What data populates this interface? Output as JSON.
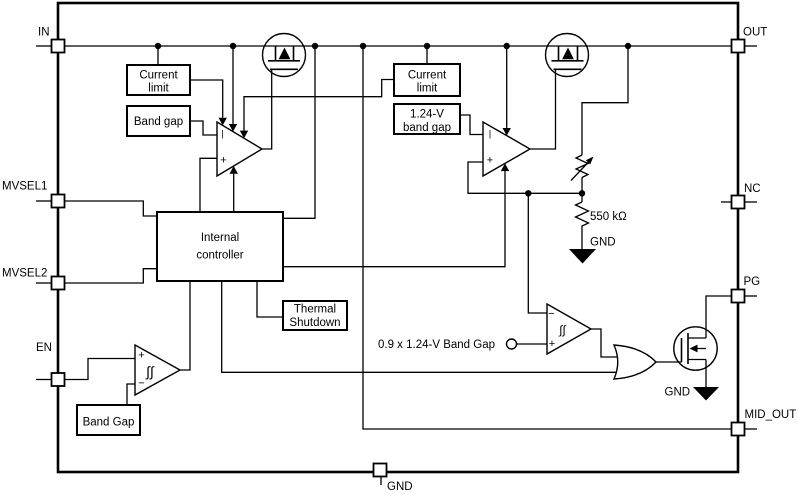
{
  "pins": {
    "in": "IN",
    "mvsel1": "MVSEL1",
    "mvsel2": "MVSEL2",
    "en": "EN",
    "out": "OUT",
    "nc": "NC",
    "pg": "PG",
    "mid_out": "MID_OUT",
    "gnd": "GND"
  },
  "blocks": {
    "current_limit_1": {
      "line1": "Current",
      "line2": "limit"
    },
    "band_gap_1": {
      "line1": "Band gap"
    },
    "current_limit_2": {
      "line1": "Current",
      "line2": "limit"
    },
    "band_gap_124": {
      "line1": "1.24-V",
      "line2": "band gap"
    },
    "internal_controller": {
      "line1": "Internal",
      "line2": "controller"
    },
    "thermal_shutdown": {
      "line1": "Thermal",
      "line2": "Shutdown"
    },
    "band_gap_en": {
      "line1": "Band Gap"
    }
  },
  "labels": {
    "resistor_550k": "550 kΩ",
    "bandgap_ref_09": "0.9 x 1.24-V Band Gap",
    "gnd_divider": "GND",
    "gnd_pg_fet": "GND",
    "gnd_pin": "GND"
  },
  "markers": {
    "plus": "+",
    "minus": "−",
    "inverting": "|",
    "hysteresis": "∫∫"
  },
  "colors": {
    "stroke": "#000000",
    "background": "#ffffff"
  }
}
